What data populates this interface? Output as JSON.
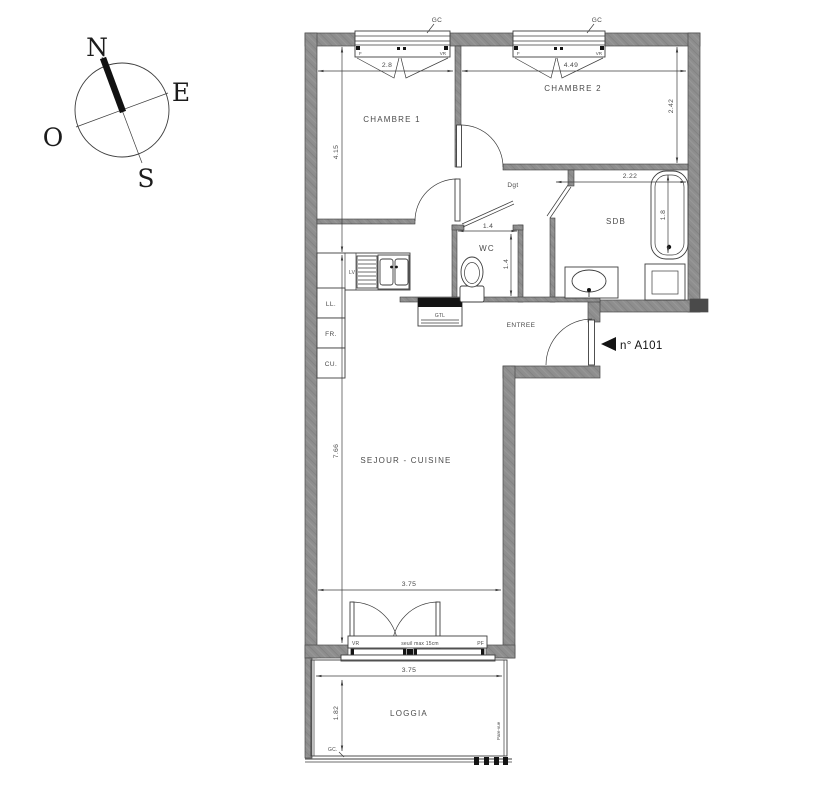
{
  "colors": {
    "wall_fill": "#8e8e8e",
    "line": "#3d3d3d",
    "text": "#4a4a4a",
    "black": "#141414",
    "background": "#ffffff"
  },
  "compass": {
    "north": "N",
    "east": "E",
    "south": "S",
    "west": "O"
  },
  "unit": {
    "label": "n° A101"
  },
  "rooms": {
    "chambre1": "CHAMBRE 1",
    "chambre2": "CHAMBRE 2",
    "dgt": "Dgt",
    "wc": "WC",
    "sdb": "SDB",
    "entree": "ENTREE",
    "sejour_cuisine": "SEJOUR - CUISINE",
    "loggia": "LOGGIA"
  },
  "dimensions": {
    "chambre1_width": "2.8",
    "chambre2_width": "4.49",
    "chambre2_depth": "2.42",
    "chambre1_depth": "4.15",
    "sdb_width": "2.22",
    "bathtub_length": "1.8",
    "wc_width": "1.4",
    "wc_depth": "1.4",
    "sejour_depth": "7.66",
    "sejour_width": "3.75",
    "loggia_width": "3.75",
    "loggia_depth": "1.82"
  },
  "annotations": {
    "gc_window1": "GC",
    "gc_window2": "GC",
    "gc_loggia": "GC.",
    "window1_f": "F",
    "window1_vr": "VR",
    "window2_f": "F",
    "window2_vr": "VR",
    "lv": "LV",
    "ll": "LL.",
    "fr": "FR.",
    "cu": "CU.",
    "gtl": "GTL",
    "bay_vr": "VR",
    "bay_seuil": "seuil max 15cm",
    "bay_pf": "PF",
    "pare_vue": "Pare-vue"
  }
}
